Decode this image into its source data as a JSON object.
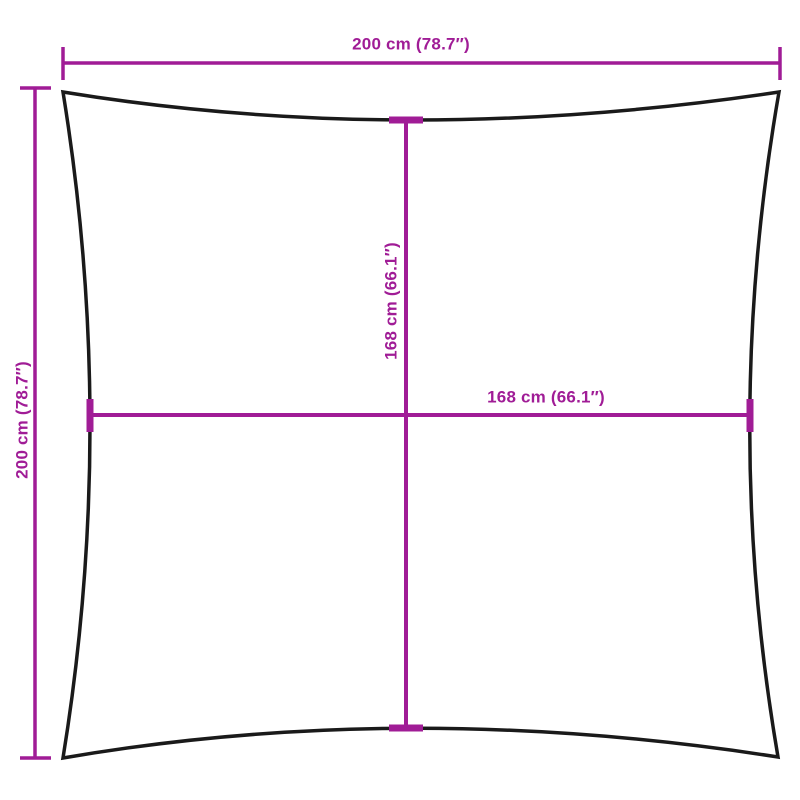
{
  "diagram": {
    "outer_width_label": "200 cm (78.7″)",
    "outer_height_label": "200 cm (78.7″)",
    "inner_height_label": "168 cm (66.1″)",
    "inner_width_label": "168 cm (66.1″)"
  },
  "colors": {
    "dimension": "#A01C96",
    "outline": "#1A1A1A",
    "background": "#FFFFFF"
  }
}
